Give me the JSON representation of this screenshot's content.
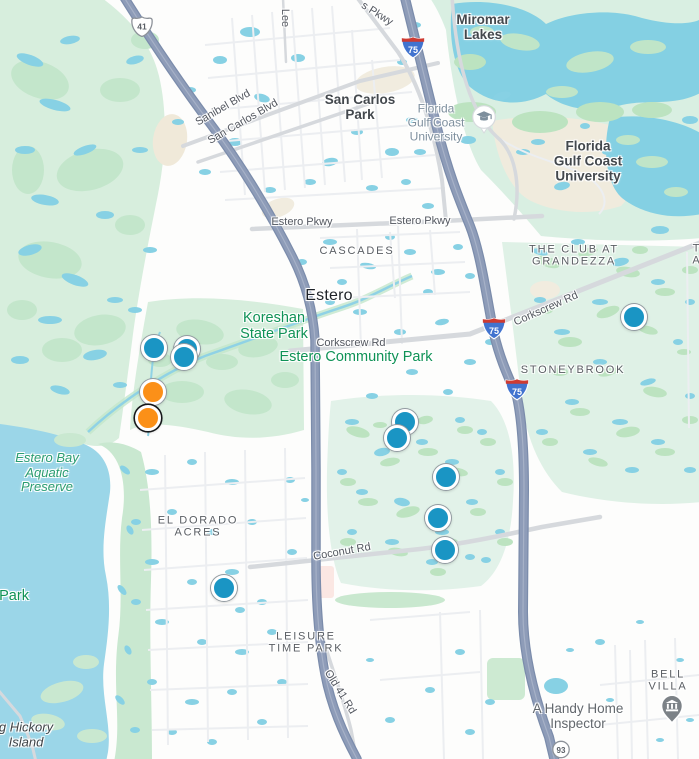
{
  "map": {
    "location_hint": "Estero, Florida area road map with listing markers",
    "colors": {
      "marker_blue": "#1a95c4",
      "marker_orange": "#fb9018",
      "water": "#9bd6e8",
      "pond": "#87d1e4",
      "park_green": "#d7eedd",
      "golf_green": "#bce3c0",
      "highway": "#8c9ab6",
      "park_label_green": "#0f9256"
    },
    "labels": [
      {
        "name": "road-label-lee",
        "text": "Lee",
        "x": 285,
        "y": 18,
        "rot": 90,
        "cls": "road"
      },
      {
        "name": "road-label-oaks-pkwy",
        "text": "s Pkwy",
        "x": 377,
        "y": 14,
        "rot": 32,
        "cls": "road"
      },
      {
        "name": "place-label-miromar-lakes",
        "text": "Miromar\nLakes",
        "x": 483,
        "y": 27,
        "cls": "town"
      },
      {
        "name": "road-label-sanibel-blvd",
        "text": "Sanibel Blvd",
        "x": 223,
        "y": 108,
        "rot": -30,
        "cls": "road"
      },
      {
        "name": "road-label-san-carlos-blvd",
        "text": "San Carlos Blvd",
        "x": 243,
        "y": 122,
        "rot": -30,
        "cls": "road"
      },
      {
        "name": "place-label-san-carlos-park",
        "text": "San Carlos\nPark",
        "x": 360,
        "y": 107,
        "cls": "town"
      },
      {
        "name": "poi-label-fgcu",
        "text": "Florida\nGulf Coast\nUniversity",
        "x": 436,
        "y": 123,
        "cls": "poi"
      },
      {
        "name": "place-label-fgcu-area",
        "text": "Florida\nGulf Coast\nUniversity",
        "x": 588,
        "y": 161,
        "cls": "town"
      },
      {
        "name": "road-label-estero-pkwy-west",
        "text": "Estero Pkwy",
        "x": 302,
        "y": 222,
        "cls": "road"
      },
      {
        "name": "road-label-estero-pkwy-east",
        "text": "Estero Pkwy",
        "x": 420,
        "y": 221,
        "cls": "road"
      },
      {
        "name": "place-label-cascades",
        "text": "CASCADES",
        "x": 357,
        "y": 251,
        "cls": "hood"
      },
      {
        "name": "place-label-club-at-grandezza",
        "text": "THE CLUB AT\nGRANDEZZA",
        "x": 574,
        "y": 256,
        "cls": "hood"
      },
      {
        "name": "place-label-clipped-right",
        "text": "T\nA",
        "x": 697,
        "y": 255,
        "cls": "hood"
      },
      {
        "name": "place-label-estero",
        "text": "Estero",
        "x": 329,
        "y": 296,
        "cls": "city"
      },
      {
        "name": "park-label-koreshan",
        "text": "Koreshan\nState Park",
        "x": 274,
        "y": 326,
        "cls": "park"
      },
      {
        "name": "road-label-corkscrew-rd",
        "text": "Corkscrew Rd",
        "x": 351,
        "y": 343,
        "cls": "road"
      },
      {
        "name": "park-label-estero-community-park",
        "text": "Estero Community Park",
        "x": 356,
        "y": 357,
        "cls": "park"
      },
      {
        "name": "road-label-corkscrew-rd-east",
        "text": "Corkscrew Rd",
        "x": 546,
        "y": 309,
        "rot": -24,
        "cls": "road"
      },
      {
        "name": "place-label-stoneybrook",
        "text": "STONEYBROOK",
        "x": 573,
        "y": 370,
        "cls": "hood"
      },
      {
        "name": "water-label-estero-bay",
        "text": "Estero Bay\nAquatic\nPreserve",
        "x": 47,
        "y": 473,
        "cls": "reserve"
      },
      {
        "name": "place-label-el-dorado-acres",
        "text": "EL DORADO\nACRES",
        "x": 198,
        "y": 527,
        "cls": "hood"
      },
      {
        "name": "road-label-coconut-rd",
        "text": "Coconut Rd",
        "x": 342,
        "y": 552,
        "rot": -10,
        "cls": "road"
      },
      {
        "name": "park-label-clipped-left",
        "text": "e Park",
        "x": 8,
        "y": 596,
        "cls": "park"
      },
      {
        "name": "place-label-leisure-time-park",
        "text": "LEISURE\nTIME PARK",
        "x": 306,
        "y": 643,
        "cls": "hood"
      },
      {
        "name": "road-label-old-41-rd",
        "text": "Old 41 Rd",
        "x": 340,
        "y": 692,
        "rot": 58,
        "cls": "road"
      },
      {
        "name": "place-label-bell-villa",
        "text": "BELL VILLA",
        "x": 668,
        "y": 681,
        "cls": "hood"
      },
      {
        "name": "poi-label-handy-home-inspector",
        "text": "A Handy Home Inspector",
        "x": 578,
        "y": 716,
        "cls": "biz"
      },
      {
        "name": "island-label-hickory",
        "text": "g Hickory\nIsland",
        "x": 26,
        "y": 735,
        "cls": "island"
      }
    ],
    "shields": [
      {
        "type": "us",
        "label": "41",
        "x": 142,
        "y": 29
      },
      {
        "type": "interstate",
        "label": "75",
        "x": 413,
        "y": 50
      },
      {
        "type": "interstate",
        "label": "75",
        "x": 494,
        "y": 331
      },
      {
        "type": "interstate",
        "label": "75",
        "x": 517,
        "y": 392
      },
      {
        "type": "state",
        "label": "93",
        "x": 561,
        "y": 752
      }
    ],
    "pois": [
      {
        "name": "university-pin",
        "icon": "graduation-cap-icon",
        "x": 484,
        "y": 122
      },
      {
        "name": "home-inspector-pin",
        "icon": "building-pin-icon",
        "x": 672,
        "y": 711
      }
    ],
    "markers": [
      {
        "x": 154,
        "y": 348,
        "color": "blue"
      },
      {
        "x": 187,
        "y": 349,
        "color": "blue"
      },
      {
        "x": 184,
        "y": 357,
        "color": "blue"
      },
      {
        "x": 634,
        "y": 317,
        "color": "blue"
      },
      {
        "x": 405,
        "y": 422,
        "color": "blue"
      },
      {
        "x": 397,
        "y": 438,
        "color": "blue"
      },
      {
        "x": 446,
        "y": 477,
        "color": "blue"
      },
      {
        "x": 438,
        "y": 518,
        "color": "blue"
      },
      {
        "x": 445,
        "y": 550,
        "color": "blue"
      },
      {
        "x": 224,
        "y": 588,
        "color": "blue"
      },
      {
        "x": 153,
        "y": 392,
        "color": "orange"
      },
      {
        "x": 148,
        "y": 418,
        "color": "orange",
        "selected": true
      }
    ]
  }
}
